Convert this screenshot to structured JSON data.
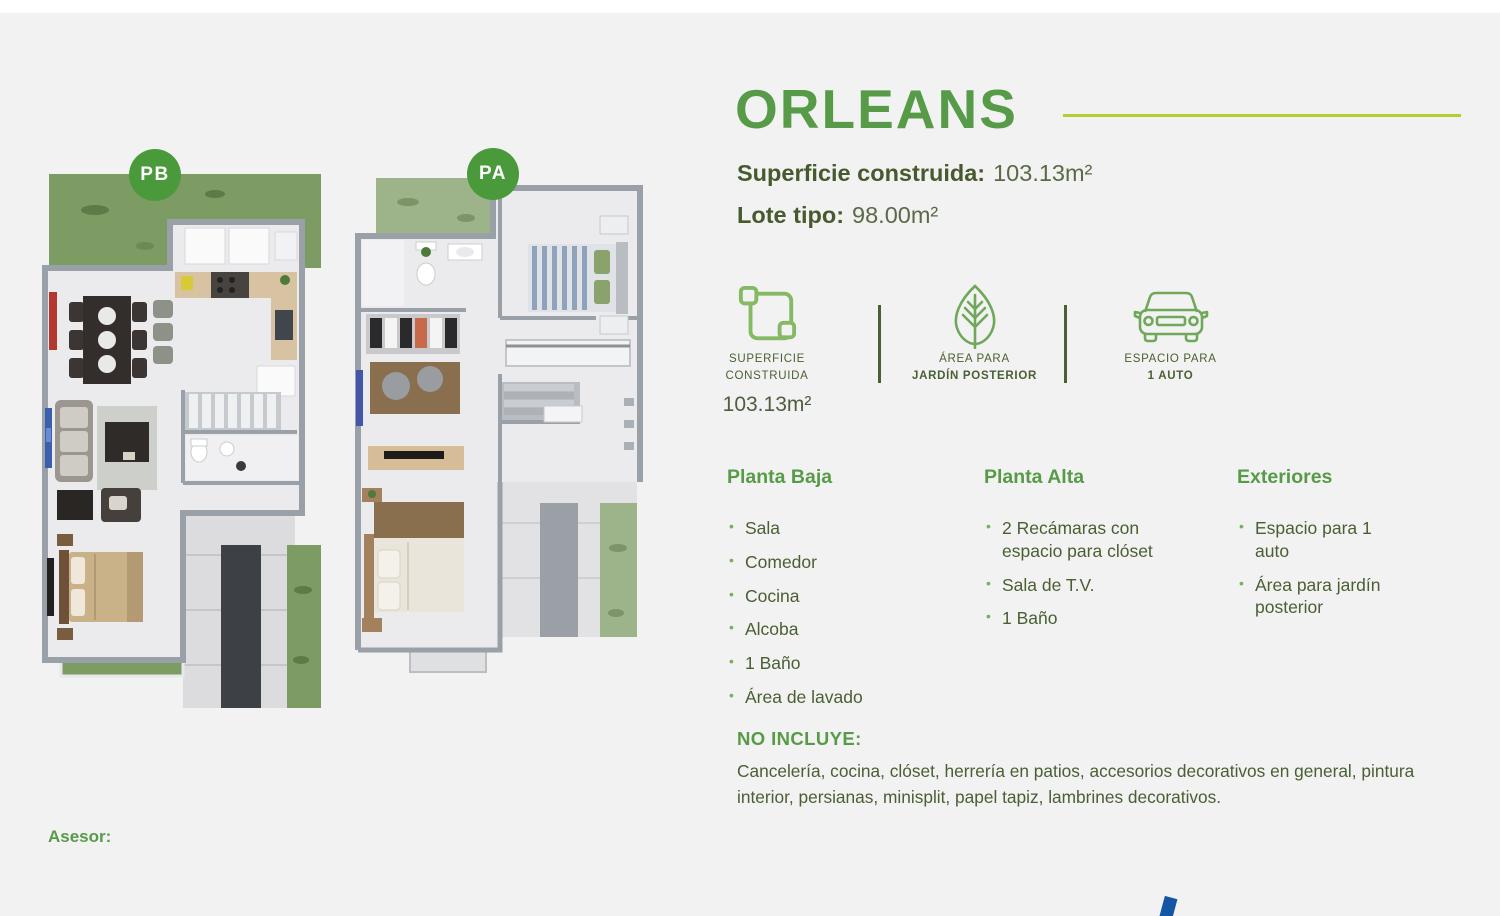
{
  "colors": {
    "background": "#f2f2f2",
    "green": "#579b48",
    "lime_line": "#b5cc35",
    "olive_text": "#4a5f33",
    "badge_green": "#4a9a3c",
    "blue_mark": "#1456a4"
  },
  "plans": {
    "pb_badge": "PB",
    "pa_badge": "PA"
  },
  "header": {
    "title": "ORLEANS",
    "superficie_label": "Superficie construida:",
    "superficie_value": "103.13m²",
    "lote_label": "Lote tipo:",
    "lote_value": "98.00m²"
  },
  "features": [
    {
      "icon": "area-icon",
      "line1": "SUPERFICIE",
      "line2": "CONSTRUIDA",
      "value": "103.13m²"
    },
    {
      "icon": "leaf-icon",
      "line1": "ÁREA PARA",
      "line2": "JARDÍN POSTERIOR",
      "value": ""
    },
    {
      "icon": "car-icon",
      "line1": "ESPACIO PARA",
      "line2": "1 AUTO",
      "value": ""
    }
  ],
  "columns": [
    {
      "title": "Planta Baja",
      "items": [
        "Sala",
        "Comedor",
        "Cocina",
        "Alcoba",
        "1 Baño",
        "Área de lavado"
      ]
    },
    {
      "title": "Planta Alta",
      "items": [
        "2 Recámaras con espacio para clóset",
        "Sala de T.V.",
        "1 Baño"
      ]
    },
    {
      "title": "Exteriores",
      "items": [
        "Espacio para 1 auto",
        "Área para jardín posterior"
      ]
    }
  ],
  "no_incluye": {
    "title": "NO INCLUYE:",
    "text": "Cancelería, cocina, clóset, herrería en patios, accesorios decorativos en general, pintura interior, persianas, minisplit, papel tapiz, lambrines decorativos."
  },
  "footer": {
    "asesor": "Asesor:"
  }
}
